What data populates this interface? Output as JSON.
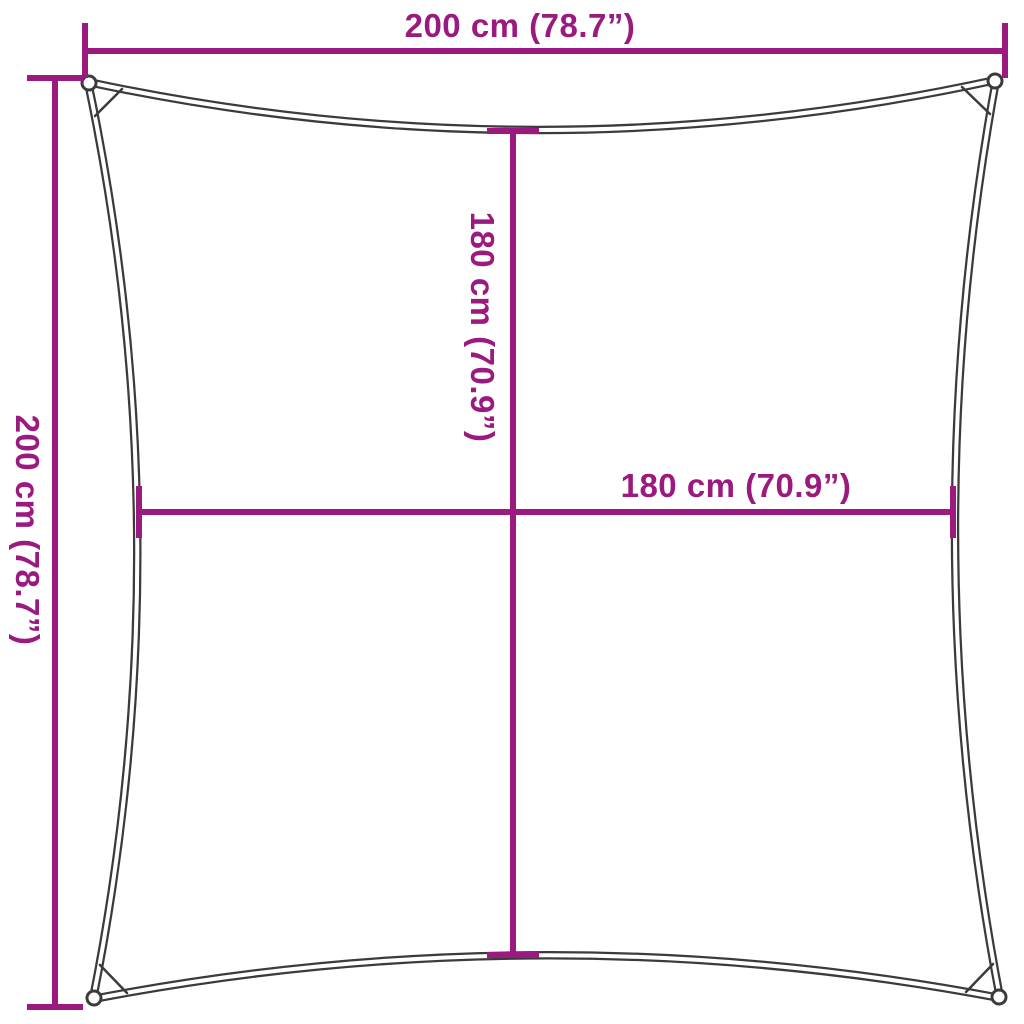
{
  "diagram": {
    "accent_color": "#9A1A7F",
    "outline_color": "#3B3B3B",
    "labels": {
      "outer_width": "200 cm (78.7”)",
      "outer_height": "200 cm (78.7”)",
      "inner_width": "180 cm (70.9”)",
      "inner_height": "180 cm (70.9”)"
    }
  }
}
